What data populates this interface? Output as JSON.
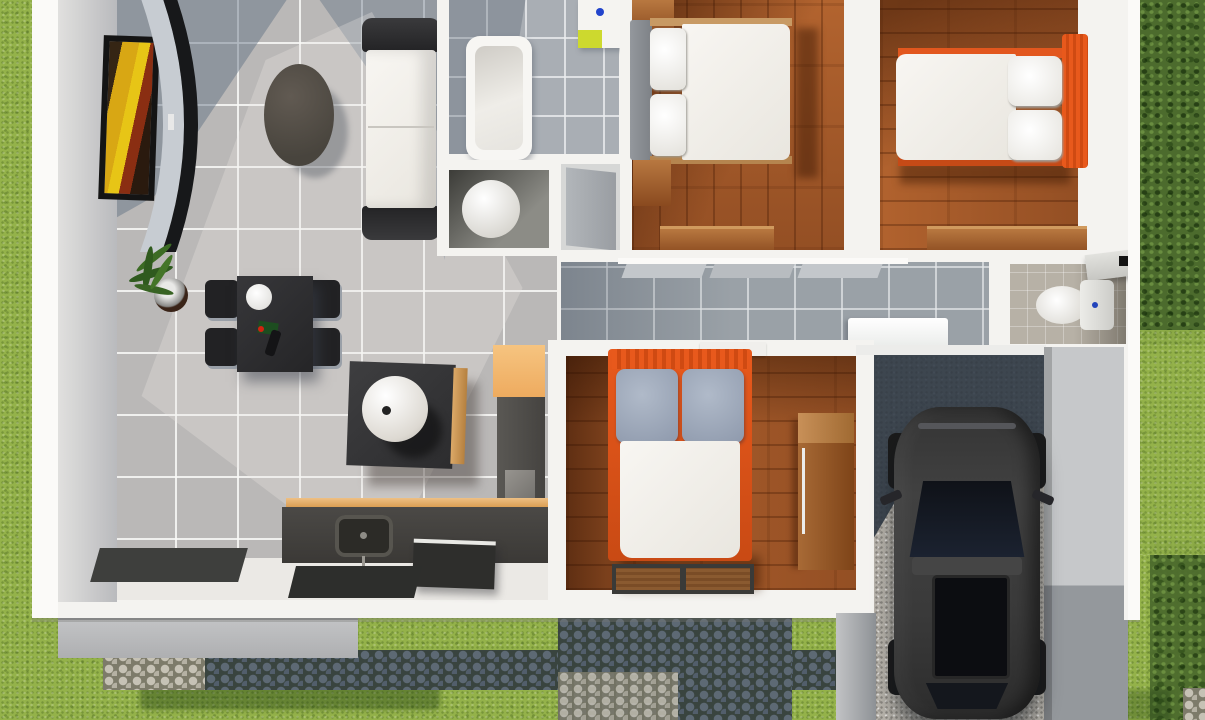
{
  "scene": {
    "kind": "3d-floor-plan-top-down-render",
    "labels": {
      "living-room": "living-room",
      "kitchen": "kitchen",
      "bathroom-main": "bathroom-main",
      "toilet-room": "toilet-room",
      "corridor": "corridor",
      "bedroom-top-left": "bedroom-1",
      "bedroom-top-right": "bedroom-2",
      "bedroom-bottom": "bedroom-3",
      "bathroom-small": "bathroom-small",
      "garage": "garage",
      "garden": "garden",
      "driveway": "driveway",
      "patio": "cobblestone-patio"
    },
    "inventory": {
      "living-room": [
        "wall-art-frame",
        "curved-tv-unit",
        "oval-coffee-table",
        "white-sofa",
        "dining-table",
        "dining-chairs-x4",
        "potted-plant",
        "floor-mat"
      ],
      "kitchen": [
        "island-with-sphere-lamp",
        "orange-counter-cabinet",
        "tall-cabinet",
        "counter-with-sink",
        "appliance-box",
        "floor-mats"
      ],
      "bathroom-main": [
        "bathtub",
        "washbasin-lime"
      ],
      "toilet-room": [
        "round-toilet"
      ],
      "corridor": [
        "sliding-door-panels",
        "washer-box"
      ],
      "bedroom-1": [
        "double-bed-gray-headboard",
        "wardrobe",
        "nightstand",
        "dresser"
      ],
      "bedroom-2": [
        "double-bed-orange-headboard",
        "dresser"
      ],
      "bedroom-3": [
        "double-bed-orange-headboard-gray-pillows",
        "wardrobe",
        "two-door-mats"
      ],
      "bathroom-small": [
        "toilet-with-tank",
        "corner-shelf"
      ],
      "garage": [
        "dark-suv-car",
        "gravel-floor"
      ]
    },
    "palette": {
      "grass": "#94b24a",
      "bush_green": "#4c6b2d",
      "wall_white": "#f4f3f0",
      "tile_gray": "#bab8b7",
      "tile_shadow_blue": "#7e8ba0",
      "corridor_tile": "#9aa1a7",
      "wood_floor": "#a85a29",
      "wood_dark": "#6e3414",
      "furniture_charcoal": "#2f2f31",
      "accent_orange_bed": "#e85c1f",
      "accent_orange_cabinet": "#f3bd7d",
      "lime_basin": "#cdd92e",
      "pillow_gray_blue": "#9aa5b6",
      "duvet_white": "#f4f2ed",
      "car_body": "#3a3a3a",
      "car_glass": "#14171d",
      "gravel": "#b7b3ab",
      "cobble_dark": "#39443f",
      "cobble_light": "#7d7b6a",
      "art_yellow": "#e0b414",
      "art_red": "#8a2e12"
    }
  }
}
